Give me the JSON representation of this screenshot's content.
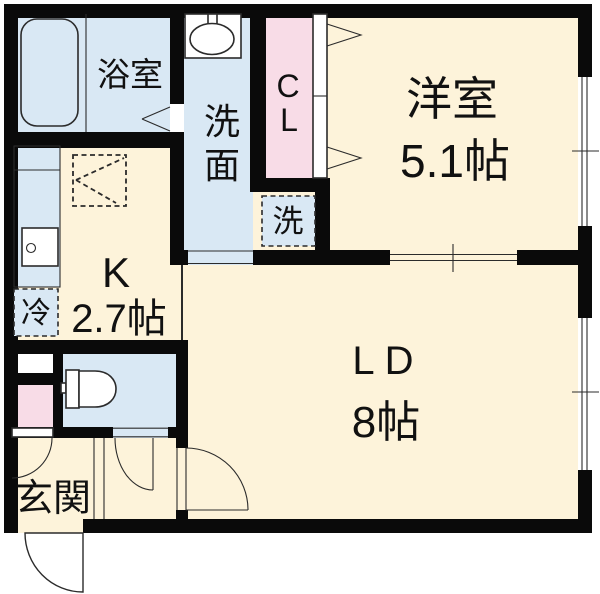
{
  "page": {
    "type": "japanese-apartment-floor-plan"
  },
  "colors": {
    "cream": "#fdf3da",
    "light_blue": "#d9e8f4",
    "pink": "#f8dce7",
    "wall": "#0a0a0a",
    "line": "#2b2b2b",
    "paper": "#ffffff"
  },
  "rooms": {
    "bathroom": {
      "label": "浴室"
    },
    "washroom": {
      "chars": [
        "洗",
        "面"
      ]
    },
    "closet": {
      "chars": [
        "C",
        "L"
      ]
    },
    "laundry": {
      "label": "洗"
    },
    "western_room": {
      "label": "洋室",
      "size": "5.1帖"
    },
    "kitchen": {
      "label": "K",
      "size": "2.7帖"
    },
    "refrigerator": {
      "label": "冷"
    },
    "living_dining": {
      "label": "LD",
      "size": "8帖"
    },
    "entrance": {
      "label": "玄関"
    }
  }
}
